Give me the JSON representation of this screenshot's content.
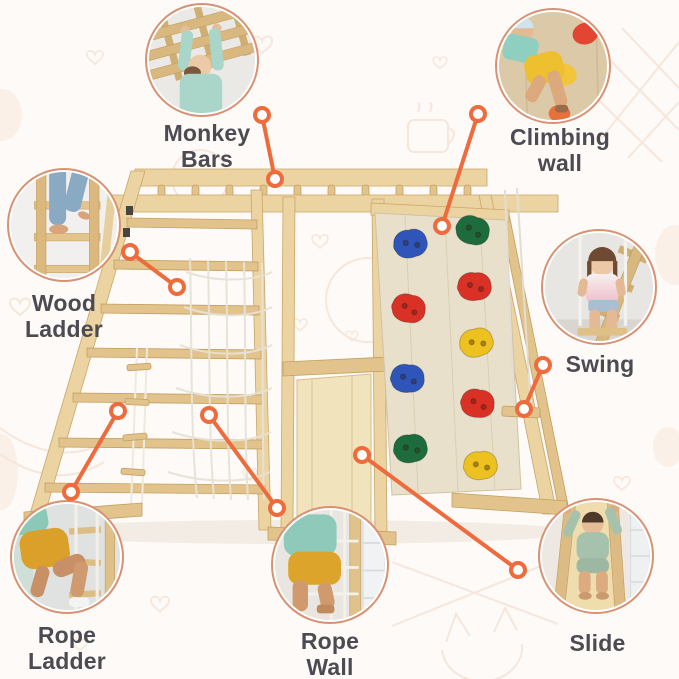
{
  "product": {
    "name": "wooden-playground-gym",
    "description": "Annotated product infographic of a wooden indoor playground with seven labeled features"
  },
  "features": [
    {
      "key": "monkey-bars",
      "label": {
        "line1": "Monkey",
        "line2": "Bars"
      },
      "photo": "child-hanging-from-monkey-bars"
    },
    {
      "key": "climbing-wall",
      "label": {
        "line1": "Climbing",
        "line2": "wall"
      },
      "photo": "child-climbing-wall-with-colorful-holds"
    },
    {
      "key": "wood-ladder",
      "label": {
        "line1": "Wood",
        "line2": "Ladder"
      },
      "photo": "child-in-jeans-climbing-wood-ladder"
    },
    {
      "key": "swing",
      "label": {
        "line1": "Swing",
        "line2": ""
      },
      "photo": "girl-sitting-on-swing"
    },
    {
      "key": "rope-ladder",
      "label": {
        "line1": "Rope",
        "line2": "Ladder"
      },
      "photo": "child-climbing-rope-ladder"
    },
    {
      "key": "rope-wall",
      "label": {
        "line1": "Rope",
        "line2": "Wall"
      },
      "photo": "child-climbing-rope-net-wall"
    },
    {
      "key": "slide",
      "label": {
        "line1": "Slide",
        "line2": ""
      },
      "photo": "child-sitting-on-wooden-slide"
    }
  ],
  "climbing_holds": [
    {
      "position": "left-1",
      "color": "#2e55b7"
    },
    {
      "position": "left-2",
      "color": "#da3127"
    },
    {
      "position": "left-3",
      "color": "#2e55b7"
    },
    {
      "position": "left-4",
      "color": "#1e6b3e"
    },
    {
      "position": "right-1",
      "color": "#1e6b3e"
    },
    {
      "position": "right-2",
      "color": "#da3127"
    },
    {
      "position": "right-3",
      "color": "#edc11f"
    },
    {
      "position": "right-4",
      "color": "#da3127"
    },
    {
      "position": "right-5",
      "color": "#edc11f"
    }
  ],
  "colors": {
    "accent": "#ed6b3c",
    "circle_ring": "#d89273",
    "label_text": "#4c4b52",
    "background": "#fdfaf7",
    "wood": "#ecd3a2",
    "doodle": "#f3dbcc"
  }
}
